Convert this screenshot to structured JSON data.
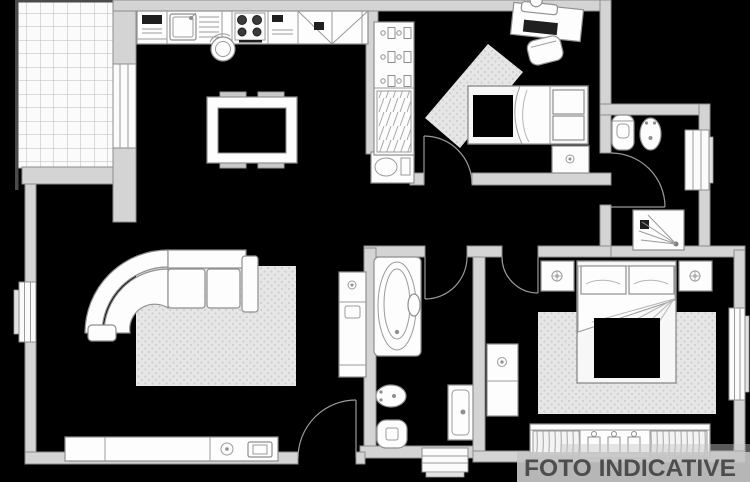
{
  "watermark": {
    "text": "FOTO INDICATIVE"
  },
  "palette": {
    "background": "#000000",
    "wall_fill": "#d4d4d4",
    "wall_stroke": "#8d8d8d",
    "furniture_fill": "#fdfdfd",
    "furniture_stroke": "#8f8f8f",
    "rug_fill": "#e6e6e6",
    "rug_dot": "#cfcfcf",
    "tile_line": "#b9b9b9",
    "watermark_bar": "#c6c6c6",
    "watermark_text": "#4d4d4d"
  },
  "plan": {
    "type": "apartment-floor-plan",
    "furniture_icons": [
      "balcony-tiles",
      "balcony-railing",
      "balcony-door",
      "kitchen-counter",
      "kitchen-sink",
      "stove-burners",
      "kitchen-stool",
      "dining-table",
      "corner-sofa",
      "living-rug",
      "tv-sideboard",
      "living-cabinet",
      "entry-door",
      "hall-console",
      "wardrobe-hangers",
      "wardrobe-shelves",
      "desk",
      "desk-chair",
      "single-bed",
      "bedroom-rug",
      "nightstand",
      "toilet",
      "bidet",
      "shower",
      "bathtub",
      "washbasin",
      "double-bed",
      "master-rug",
      "dresser",
      "master-wardrobe",
      "window",
      "door-arc"
    ]
  }
}
